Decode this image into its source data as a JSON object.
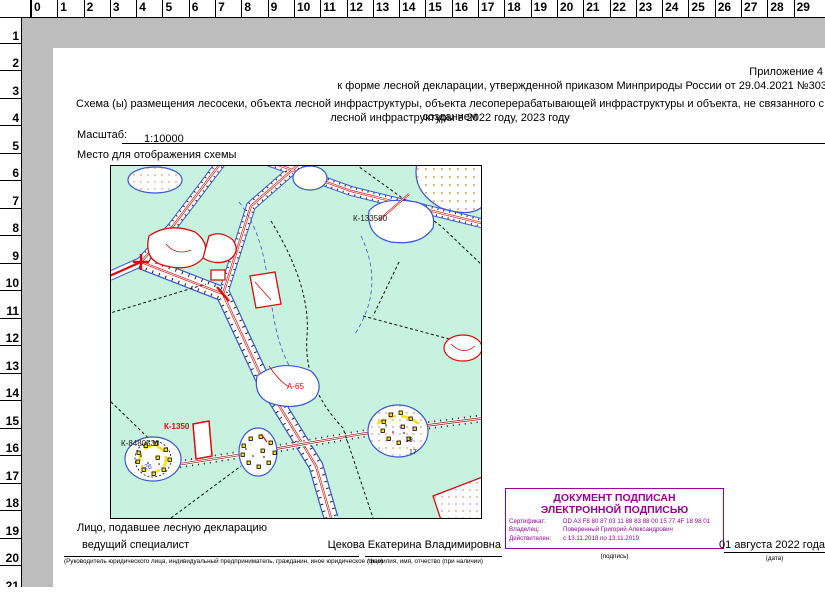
{
  "rulers": {
    "top": [
      "0",
      "1",
      "2",
      "3",
      "4",
      "5",
      "6",
      "7",
      "8",
      "9",
      "10",
      "11",
      "12",
      "13",
      "14",
      "15",
      "16",
      "17",
      "18",
      "19",
      "20",
      "21",
      "22",
      "23",
      "24",
      "25",
      "26",
      "27",
      "28",
      "29"
    ],
    "left": [
      "0",
      "1",
      "2",
      "3",
      "4",
      "5",
      "6",
      "7",
      "8",
      "9",
      "10",
      "11",
      "12",
      "13",
      "14",
      "15",
      "16",
      "17",
      "18",
      "19",
      "20",
      "21"
    ]
  },
  "doc": {
    "appendix_line1": "Приложение 4",
    "appendix_line2": "к форме лесной декларации, утвержденной приказом Минприроды России от 29.04.2021 №303",
    "title_line1": "Схема (ы) размещения лесосеки, объекта лесной инфраструктуры, объекта лесоперерабатывающей инфраструктуры и  объекта, не связанного с созданием",
    "title_line2": "лесной инфраструктуры в 2022 году, 2023 году",
    "scale_label": "Масштаб:",
    "scale_value": "1:10000",
    "map_placeholder_label": "Место для отображения схемы"
  },
  "map": {
    "background": "#c6f2df",
    "road_color": "#dd0a0a",
    "boundary_color": "#3a57d0",
    "labels": [
      {
        "text": "К-133580",
        "x": 242,
        "y": 55,
        "color": "#1a1a1a",
        "bold": false
      },
      {
        "text": "А-65",
        "x": 176,
        "y": 223,
        "color": "#dd0a0a",
        "bold": false
      },
      {
        "text": "К-1350",
        "x": 53,
        "y": 263,
        "color": "#dd0a0a",
        "bold": true
      },
      {
        "text": "К-8480530",
        "x": 10,
        "y": 280,
        "color": "#1a1a1a",
        "bold": false
      },
      {
        "text": "26",
        "x": 33,
        "y": 303,
        "color": "#3a57d0",
        "bold": false
      },
      {
        "text": "19",
        "x": 294,
        "y": 276,
        "color": "#1a1a1a",
        "bold": false
      },
      {
        "text": "17",
        "x": 298,
        "y": 288,
        "color": "#1a1a1a",
        "bold": false
      }
    ]
  },
  "signer": {
    "section_label": "Лицо, подавшее лесную декларацию",
    "position": "ведущий специалист",
    "position_note": "(Руководитель юридического лица, индивидуальный предприниматель, гражданин, иное юридическое лицо)",
    "name": "Цекова Екатерина Владимировна",
    "name_note": "(фамилия, имя, отчество (при наличии)",
    "signature_note": "(подпись)",
    "date": "01 августа 2022 года",
    "date_note": "(дата)"
  },
  "stamp": {
    "color": "#990099",
    "title_line1": "ДОКУМЕНТ ПОДПИСАН",
    "title_line2": "ЭЛЕКТРОННОЙ ПОДПИСЬЮ",
    "cert_label": "Сертификат:",
    "cert_value": "DD A3 F8 80 87 03 11 88 83 88 00 15 77 4F 18 98 01",
    "owner_label": "Владелец:",
    "owner_value": "Поверенный Григорий Александрович",
    "valid_label": "Действителен:",
    "valid_value": "с 13.11.2018 по 13.11.2019"
  }
}
